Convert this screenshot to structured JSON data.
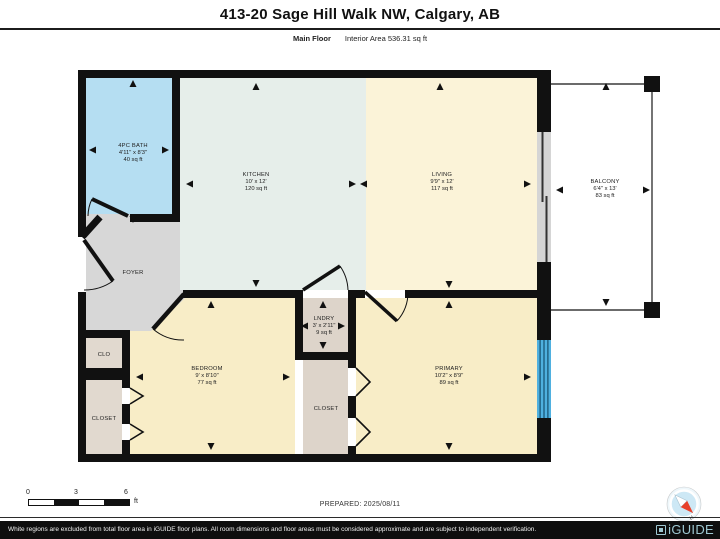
{
  "header": {
    "title": "413-20 Sage Hill Walk NW, Calgary, AB",
    "floor_label": "Main Floor",
    "area_label": "Interior Area 536.31 sq ft"
  },
  "rooms": {
    "bath": {
      "name": "4PC BATH",
      "dims": "4'11\" x 8'3\"",
      "area": "40 sq ft"
    },
    "kitchen": {
      "name": "KITCHEN",
      "dims": "10' x 12'",
      "area": "120 sq ft"
    },
    "living": {
      "name": "LIVING",
      "dims": "9'9\" x 12'",
      "area": "117 sq ft"
    },
    "balcony": {
      "name": "BALCONY",
      "dims": "6'4\" x 13'",
      "area": "83 sq ft"
    },
    "foyer": {
      "name": "FOYER"
    },
    "clo": {
      "name": "CLO"
    },
    "closet_left": {
      "name": "CLOSET"
    },
    "bedroom": {
      "name": "BEDROOM",
      "dims": "9' x 8'10\"",
      "area": "77 sq ft"
    },
    "lndry": {
      "name": "LNDRY",
      "dims": "3' x 2'11\"",
      "area": "9 sq ft"
    },
    "closet_mid": {
      "name": "CLOSET"
    },
    "primary": {
      "name": "PRIMARY",
      "dims": "10'2\" x 8'9\"",
      "area": "89 sq ft"
    }
  },
  "scale_bar": {
    "tick0": "0",
    "tick3": "3",
    "tick6": "6",
    "unit": "ft"
  },
  "prepared": "PREPARED: 2025/08/11",
  "compass": {
    "north_label": "N"
  },
  "footer": {
    "disclaimer": "White regions are excluded from total floor area in iGUIDE floor plans. All room dimensions and floor areas must be considered approximate and are subject to independent verification.",
    "brand": "iGUIDE"
  },
  "colors": {
    "wall": "#111111",
    "bath": "#b5def2",
    "kitchen": "#e6eeea",
    "living": "#fbf3d8",
    "bedroom": "#f8edc7",
    "primary": "#f8edc7",
    "foyer": "#d7d7d7",
    "closet_beige": "#e1d9cf",
    "lndry_beige": "#ddd4ca",
    "balcony": "#ffffff",
    "window": "#4fb0e0",
    "sliding_door": "#d5d5d5",
    "brand_blue": "#9ec8d2",
    "compass_fill": "#cde8f5",
    "needle_red": "#e8402a"
  }
}
